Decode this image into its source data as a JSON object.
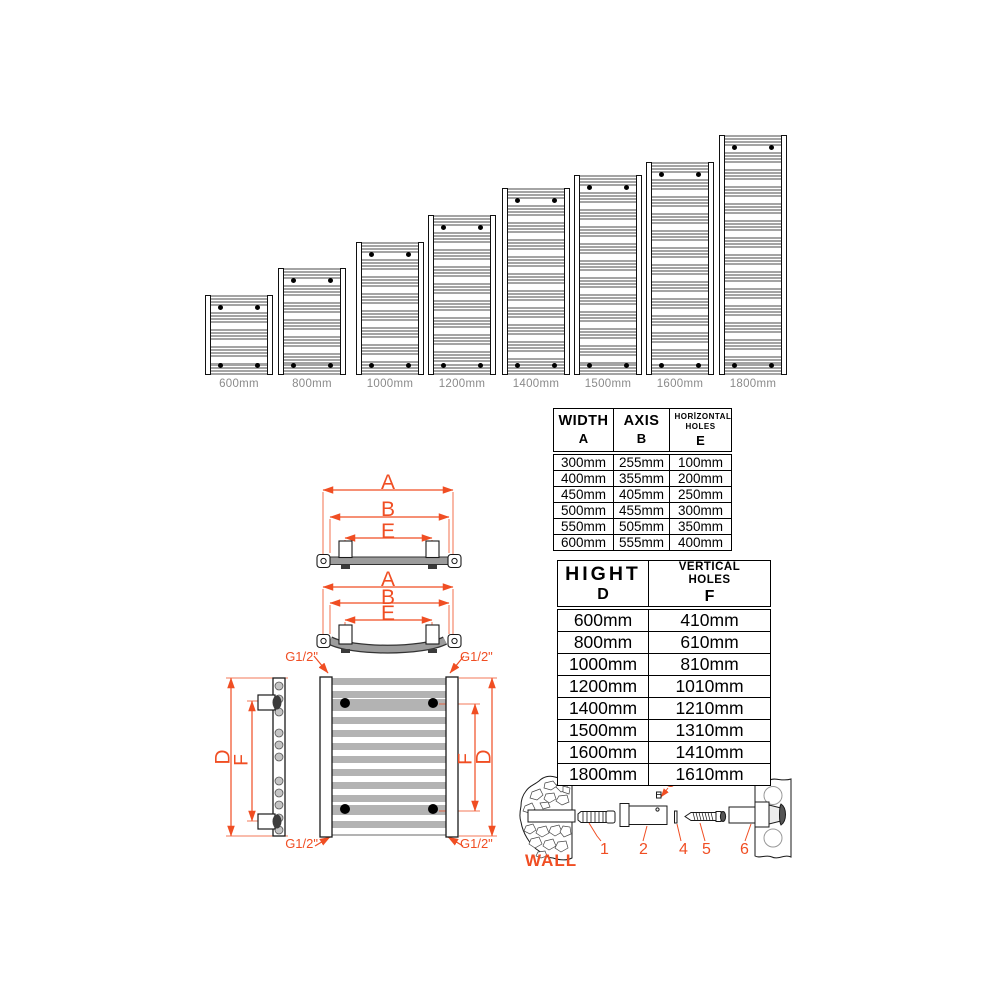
{
  "colors": {
    "accent_orange": "#f04e23",
    "bar_gray": "#a4a4a4",
    "label_gray": "#8a8a8a"
  },
  "radiator_series": {
    "items": [
      {
        "label": "600mm",
        "height_mm": 600
      },
      {
        "label": "800mm",
        "height_mm": 800
      },
      {
        "label": "1000mm",
        "height_mm": 1000
      },
      {
        "label": "1200mm",
        "height_mm": 1200
      },
      {
        "label": "1400mm",
        "height_mm": 1400
      },
      {
        "label": "1500mm",
        "height_mm": 1500
      },
      {
        "label": "1600mm",
        "height_mm": 1600
      },
      {
        "label": "1800mm",
        "height_mm": 1800
      }
    ]
  },
  "dimension_labels": {
    "width": "A",
    "axis": "B",
    "horizontal_holes": "E",
    "height": "D",
    "vertical_holes": "F",
    "pipe_thread": "G1/2\""
  },
  "spec_tables": {
    "width_table": {
      "columns": [
        {
          "title": "WIDTH",
          "symbol": "A"
        },
        {
          "title": "AXIS",
          "symbol": "B"
        },
        {
          "title": "HORİZONTAL HOLES",
          "symbol": "E"
        }
      ],
      "rows": [
        [
          "300mm",
          "255mm",
          "100mm"
        ],
        [
          "400mm",
          "355mm",
          "200mm"
        ],
        [
          "450mm",
          "405mm",
          "250mm"
        ],
        [
          "500mm",
          "455mm",
          "300mm"
        ],
        [
          "550mm",
          "505mm",
          "350mm"
        ],
        [
          "600mm",
          "555mm",
          "400mm"
        ]
      ]
    },
    "height_table": {
      "columns": [
        {
          "title": "HIGHT",
          "symbol": "D"
        },
        {
          "title": "VERTICAL HOLES",
          "symbol": "F"
        }
      ],
      "rows": [
        [
          "600mm",
          "410mm"
        ],
        [
          "800mm",
          "610mm"
        ],
        [
          "1000mm",
          "810mm"
        ],
        [
          "1200mm",
          "1010mm"
        ],
        [
          "1400mm",
          "1210mm"
        ],
        [
          "1500mm",
          "1310mm"
        ],
        [
          "1600mm",
          "1410mm"
        ],
        [
          "1800mm",
          "1610mm"
        ]
      ]
    }
  },
  "mounting_hardware": {
    "wall_label": "WALL",
    "part_numbers": [
      "1",
      "2",
      "3",
      "4",
      "5",
      "6"
    ]
  }
}
